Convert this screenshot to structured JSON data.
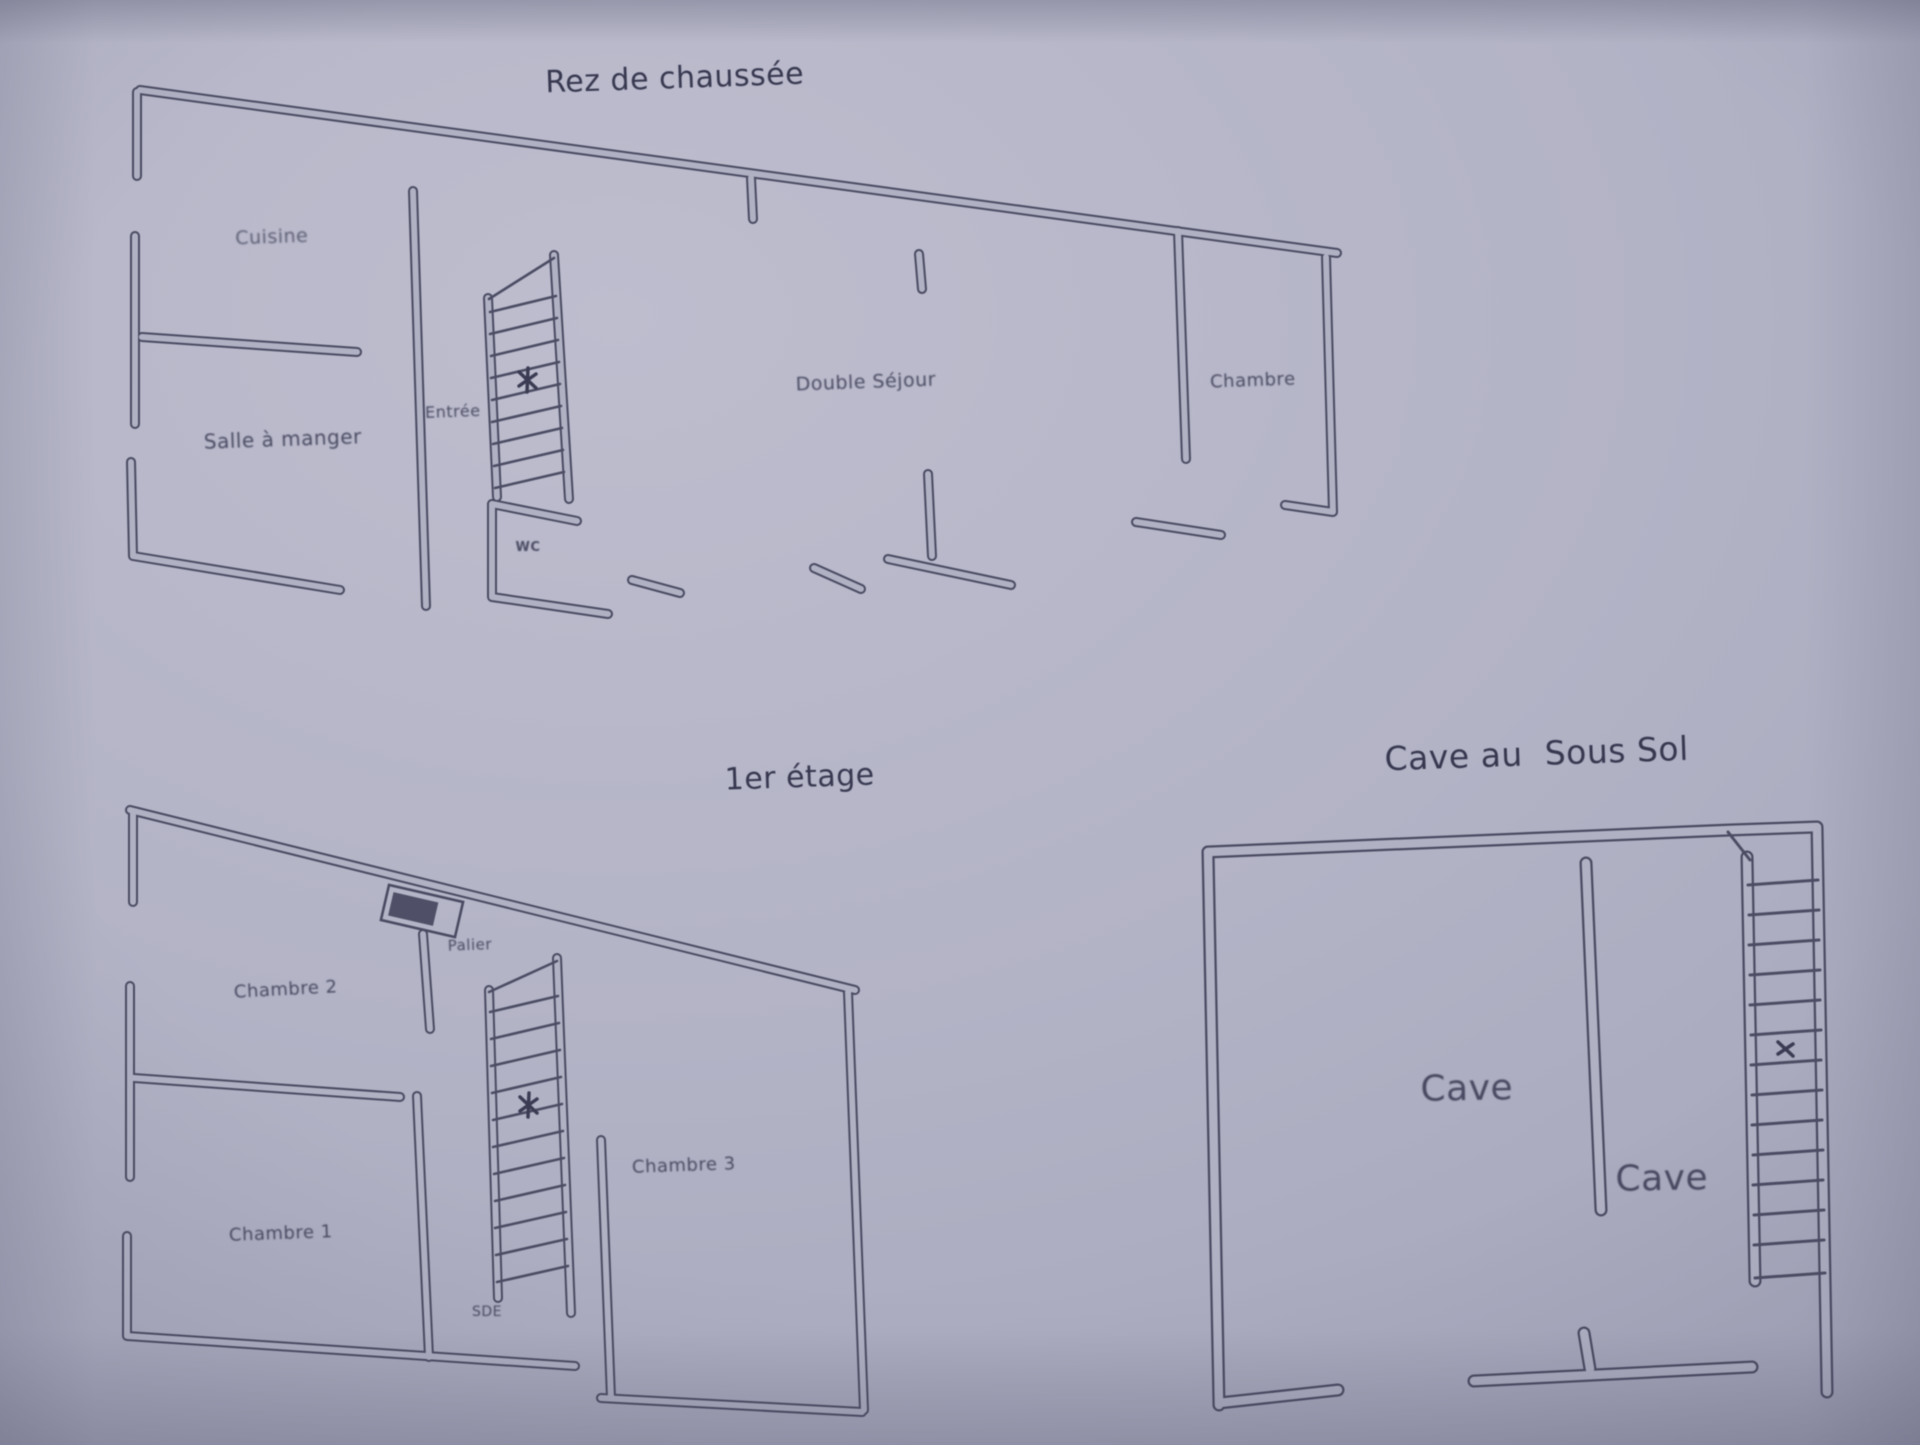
{
  "document_type": "floor-plan-photo",
  "colors": {
    "paper": "#b3b3c6",
    "ink": "#4a4a62",
    "text": "#32324c"
  },
  "plans": [
    {
      "id": "rez-de-chaussee",
      "title": "Rez de chaussée",
      "rooms": [
        {
          "name": "cuisine",
          "label": "Cuisine"
        },
        {
          "name": "salle-a-manger",
          "label": "Salle à manger"
        },
        {
          "name": "entree",
          "label": "Entrée"
        },
        {
          "name": "wc",
          "label": "WC"
        },
        {
          "name": "double-sejour",
          "label": "Double Séjour"
        },
        {
          "name": "chambre",
          "label": "Chambre"
        }
      ]
    },
    {
      "id": "premier-etage",
      "title": "1er étage",
      "rooms": [
        {
          "name": "chambre-2",
          "label": "Chambre 2"
        },
        {
          "name": "palier",
          "label": "Palier"
        },
        {
          "name": "chambre-1",
          "label": "Chambre 1"
        },
        {
          "name": "sde",
          "label": "SDE"
        },
        {
          "name": "chambre-3",
          "label": "Chambre 3"
        }
      ]
    },
    {
      "id": "cave-au-sous-sol",
      "title": "Cave au  Sous Sol",
      "rooms": [
        {
          "name": "cave-1",
          "label": "Cave"
        },
        {
          "name": "cave-2",
          "label": "Cave"
        }
      ]
    }
  ]
}
